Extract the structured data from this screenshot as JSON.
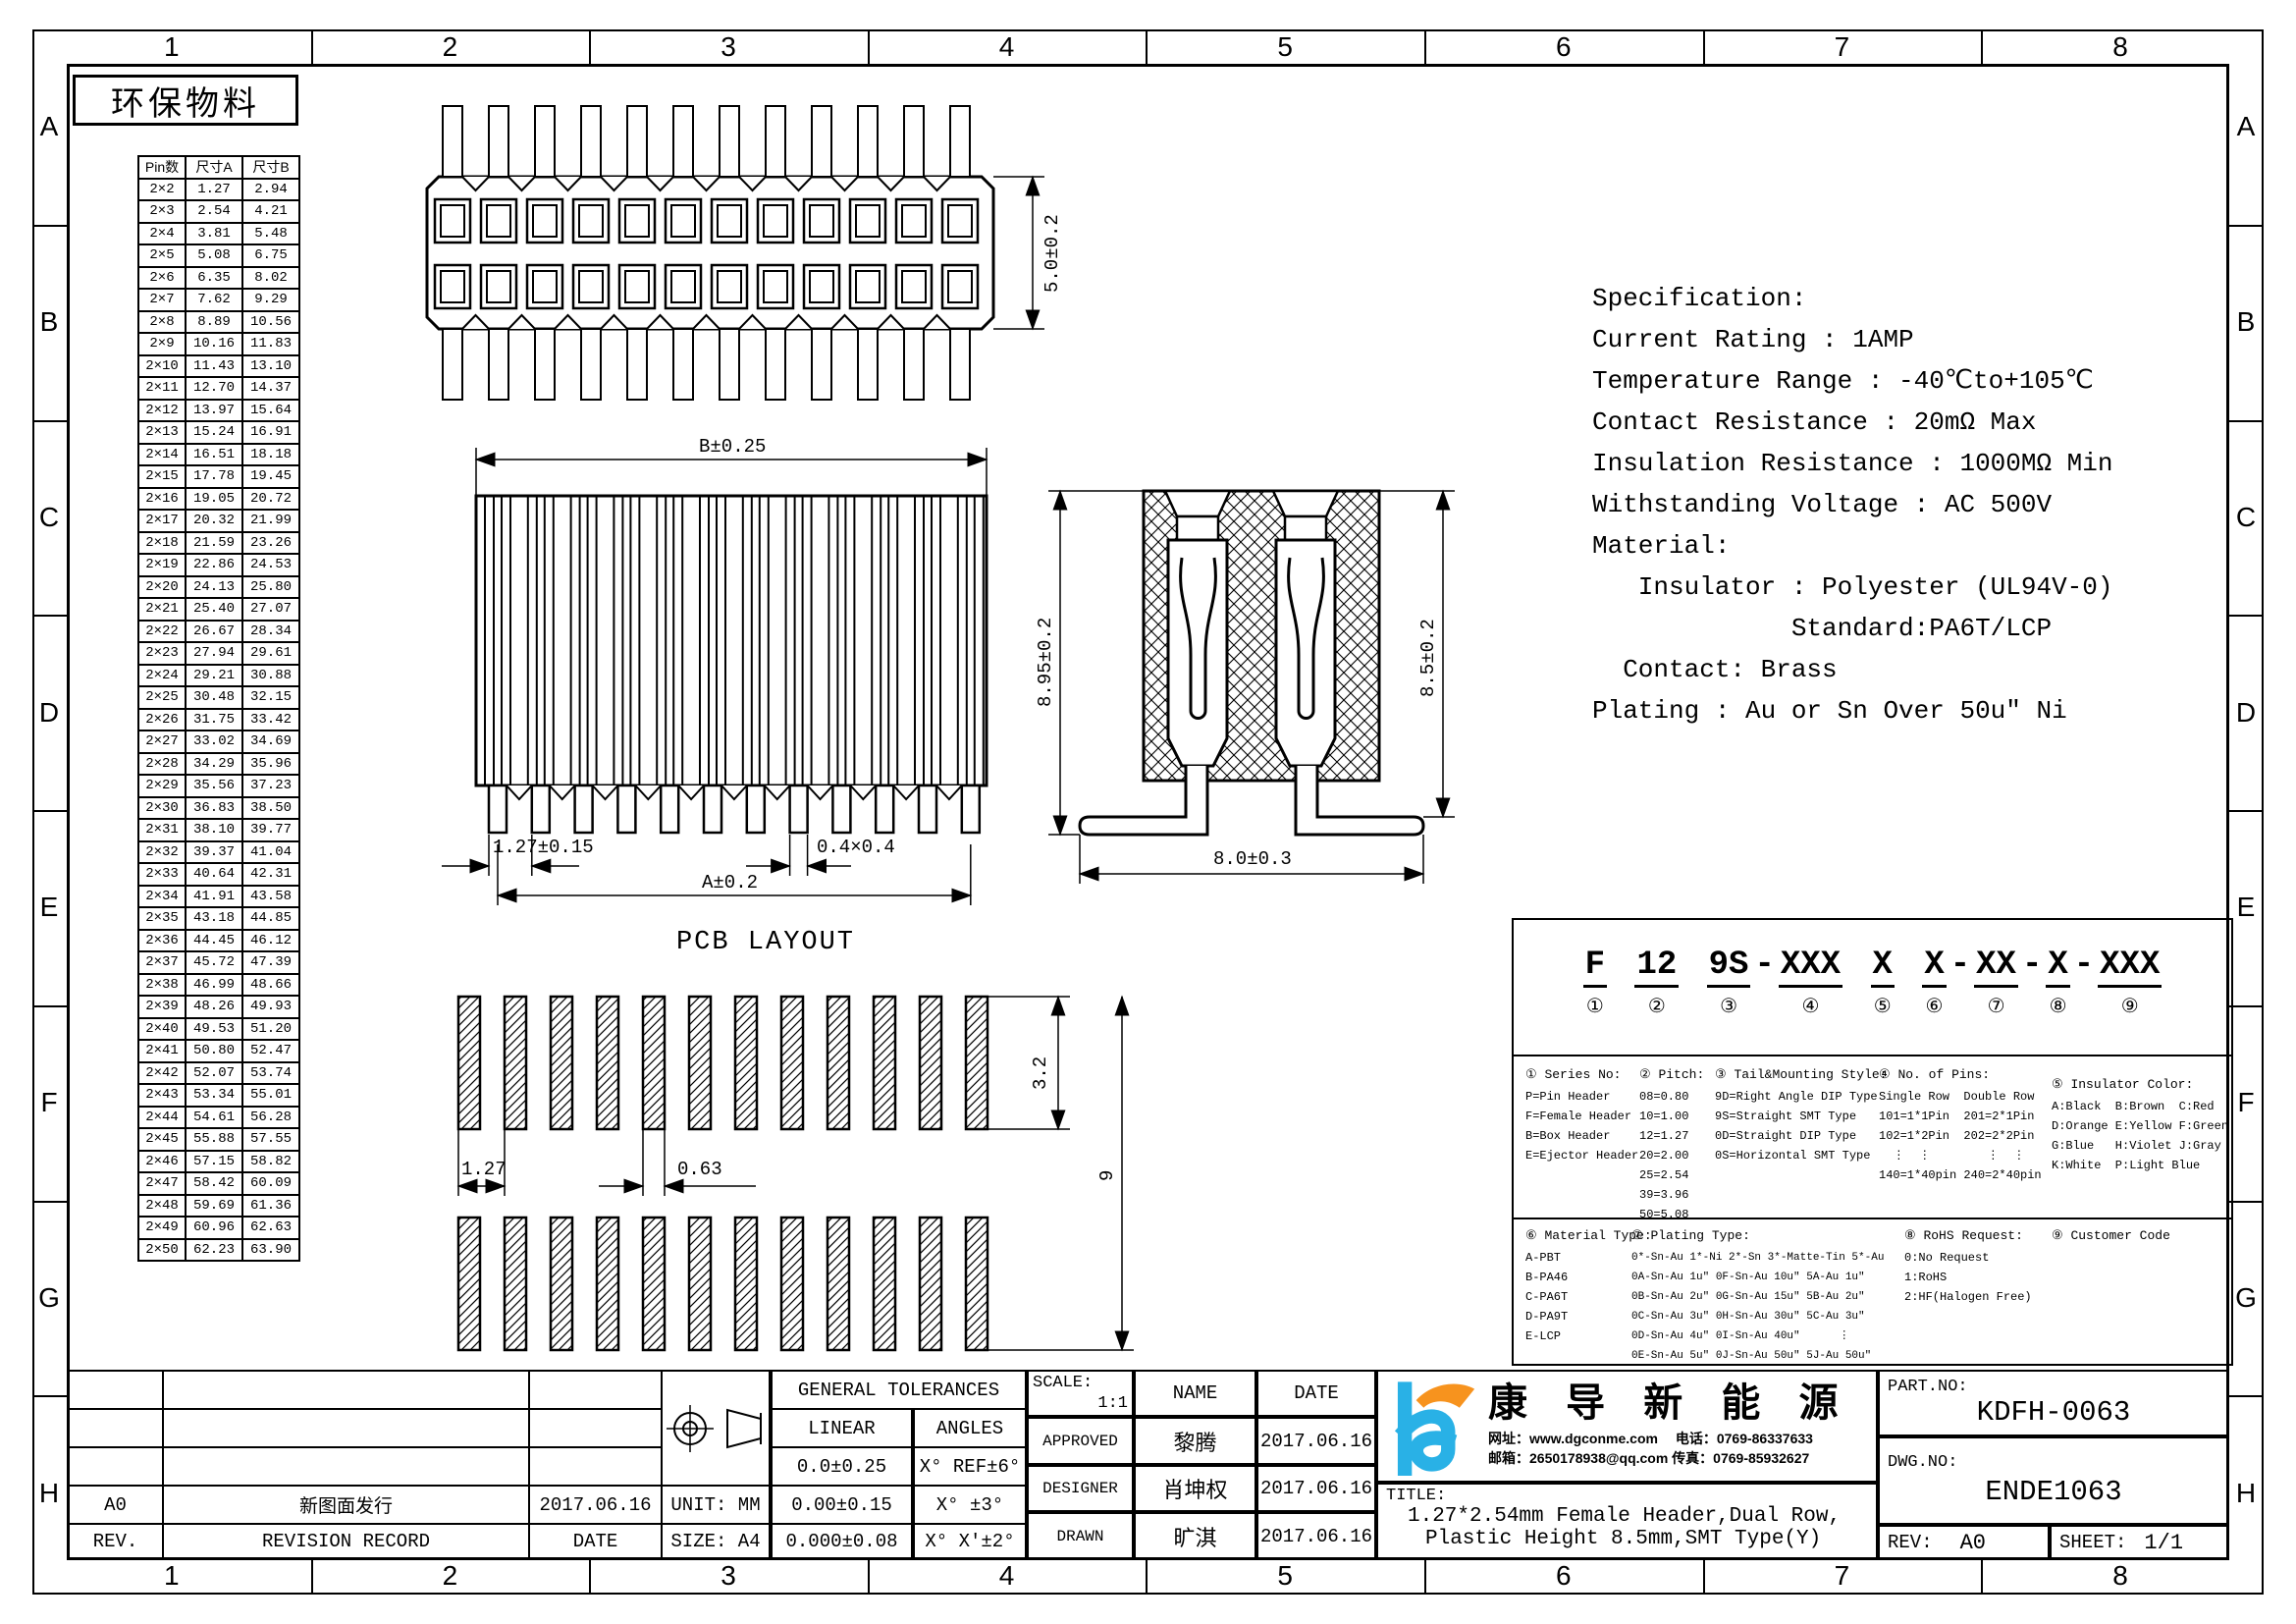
{
  "page": {
    "eco_label": "环保物料",
    "pcb_layout_title": "PCB LAYOUT"
  },
  "zones": {
    "columns": [
      "1",
      "2",
      "3",
      "4",
      "5",
      "6",
      "7",
      "8"
    ],
    "rows": [
      "A",
      "B",
      "C",
      "D",
      "E",
      "F",
      "G",
      "H"
    ]
  },
  "pin_table": {
    "headers": [
      "Pin数",
      "尺寸A",
      "尺寸B"
    ],
    "rows": [
      [
        "2×2",
        "1.27",
        "2.94"
      ],
      [
        "2×3",
        "2.54",
        "4.21"
      ],
      [
        "2×4",
        "3.81",
        "5.48"
      ],
      [
        "2×5",
        "5.08",
        "6.75"
      ],
      [
        "2×6",
        "6.35",
        "8.02"
      ],
      [
        "2×7",
        "7.62",
        "9.29"
      ],
      [
        "2×8",
        "8.89",
        "10.56"
      ],
      [
        "2×9",
        "10.16",
        "11.83"
      ],
      [
        "2×10",
        "11.43",
        "13.10"
      ],
      [
        "2×11",
        "12.70",
        "14.37"
      ],
      [
        "2×12",
        "13.97",
        "15.64"
      ],
      [
        "2×13",
        "15.24",
        "16.91"
      ],
      [
        "2×14",
        "16.51",
        "18.18"
      ],
      [
        "2×15",
        "17.78",
        "19.45"
      ],
      [
        "2×16",
        "19.05",
        "20.72"
      ],
      [
        "2×17",
        "20.32",
        "21.99"
      ],
      [
        "2×18",
        "21.59",
        "23.26"
      ],
      [
        "2×19",
        "22.86",
        "24.53"
      ],
      [
        "2×20",
        "24.13",
        "25.80"
      ],
      [
        "2×21",
        "25.40",
        "27.07"
      ],
      [
        "2×22",
        "26.67",
        "28.34"
      ],
      [
        "2×23",
        "27.94",
        "29.61"
      ],
      [
        "2×24",
        "29.21",
        "30.88"
      ],
      [
        "2×25",
        "30.48",
        "32.15"
      ],
      [
        "2×26",
        "31.75",
        "33.42"
      ],
      [
        "2×27",
        "33.02",
        "34.69"
      ],
      [
        "2×28",
        "34.29",
        "35.96"
      ],
      [
        "2×29",
        "35.56",
        "37.23"
      ],
      [
        "2×30",
        "36.83",
        "38.50"
      ],
      [
        "2×31",
        "38.10",
        "39.77"
      ],
      [
        "2×32",
        "39.37",
        "41.04"
      ],
      [
        "2×33",
        "40.64",
        "42.31"
      ],
      [
        "2×34",
        "41.91",
        "43.58"
      ],
      [
        "2×35",
        "43.18",
        "44.85"
      ],
      [
        "2×36",
        "44.45",
        "46.12"
      ],
      [
        "2×37",
        "45.72",
        "47.39"
      ],
      [
        "2×38",
        "46.99",
        "48.66"
      ],
      [
        "2×39",
        "48.26",
        "49.93"
      ],
      [
        "2×40",
        "49.53",
        "51.20"
      ],
      [
        "2×41",
        "50.80",
        "52.47"
      ],
      [
        "2×42",
        "52.07",
        "53.74"
      ],
      [
        "2×43",
        "53.34",
        "55.01"
      ],
      [
        "2×44",
        "54.61",
        "56.28"
      ],
      [
        "2×45",
        "55.88",
        "57.55"
      ],
      [
        "2×46",
        "57.15",
        "58.82"
      ],
      [
        "2×47",
        "58.42",
        "60.09"
      ],
      [
        "2×48",
        "59.69",
        "61.36"
      ],
      [
        "2×49",
        "60.96",
        "62.63"
      ],
      [
        "2×50",
        "62.23",
        "63.90"
      ]
    ]
  },
  "specification": {
    "lines": [
      "Specification:",
      "Current Rating : 1AMP",
      "Temperature Range : -40℃to+105℃",
      "Contact Resistance : 20mΩ Max",
      "Insulation Resistance : 1000MΩ Min",
      "Withstanding Voltage : AC 500V",
      "Material:",
      "   Insulator : Polyester (UL94V-0)",
      "             Standard:PA6T/LCP",
      "  Contact: Brass",
      "Plating : Au or Sn Over 50u″ Ni"
    ]
  },
  "dimensions": {
    "top_view_depth": "5.0±0.2",
    "front_b": "B±0.25",
    "front_pitch": "1.27±0.15",
    "front_sq": "0.4×0.4",
    "front_a": "A±0.2",
    "side_total": "8.95±0.2",
    "side_body": "8.5±0.2",
    "side_width": "8.0±0.3",
    "pcb_pitch": "1.27",
    "pcb_pad_w": "0.63",
    "pcb_pad_h": "3.2",
    "pcb_span": "9"
  },
  "part_code": {
    "segments": [
      {
        "t": "F",
        "n": "①",
        "sep": " "
      },
      {
        "t": "12",
        "n": "②",
        "sep": " "
      },
      {
        "t": "9S",
        "n": "③",
        "sep": "-"
      },
      {
        "t": "XXX",
        "n": "④",
        "sep": " "
      },
      {
        "t": "X",
        "n": "⑤",
        "sep": " "
      },
      {
        "t": "X",
        "n": "⑥",
        "sep": "-"
      },
      {
        "t": "XX",
        "n": "⑦",
        "sep": "-"
      },
      {
        "t": "X",
        "n": "⑧",
        "sep": "-"
      },
      {
        "t": "XXX",
        "n": "⑨",
        "sep": ""
      }
    ],
    "sections": {
      "series": {
        "title": "① Series No:",
        "lines": [
          "P=Pin Header",
          "F=Female Header",
          "B=Box Header",
          "E=Ejector Header"
        ]
      },
      "pitch": {
        "title": "② Pitch:",
        "lines": [
          "08=0.80",
          "10=1.00",
          "12=1.27",
          "20=2.00",
          "25=2.54",
          "39=3.96",
          "50=5.08"
        ]
      },
      "tail": {
        "title": "③ Tail&Mounting Style:",
        "lines": [
          "9D=Right Angle DIP Type",
          "9S=Straight SMT Type",
          "0D=Straight DIP Type",
          "0S=Horizontal SMT Type"
        ]
      },
      "pins": {
        "title": "④ No. of Pins:",
        "lines": [
          "Single Row  Double Row",
          "101=1*1Pin  201=2*1Pin",
          "102=1*2Pin  202=2*2Pin",
          "  ⋮  ⋮        ⋮  ⋮",
          "140=1*40pin 240=2*40pin"
        ]
      },
      "color": {
        "title": "⑤ Insulator Color:",
        "lines": [
          "A:Black  B:Brown  C:Red",
          "D:Orange E:Yellow F:Green",
          "G:Blue   H:Violet J:Gray",
          "K:White  P:Light Blue"
        ]
      },
      "material": {
        "title": "⑥ Material Type:",
        "lines": [
          "A-PBT",
          "B-PA46",
          "C-PA6T",
          "D-PA9T",
          "E-LCP"
        ]
      },
      "plating": {
        "title": "⑦ Plating Type:",
        "lines": [
          "0*-Sn-Au 1*-Ni 2*-Sn 3*-Matte-Tin 5*-Au",
          "0A-Sn-Au 1u″ 0F-Sn-Au 10u″ 5A-Au 1u″",
          "0B-Sn-Au 2u″ 0G-Sn-Au 15u″ 5B-Au 2u″",
          "0C-Sn-Au 3u″ 0H-Sn-Au 30u″ 5C-Au 3u″",
          "0D-Sn-Au 4u″ 0I-Sn-Au 40u″      ⋮",
          "0E-Sn-Au 5u″ 0J-Sn-Au 50u″ 5J-Au 50u″"
        ]
      },
      "rohs": {
        "title": "⑧ RoHS Request:",
        "lines": [
          "0:No Request",
          "1:RoHS",
          "2:HF(Halogen Free)"
        ]
      },
      "customer": {
        "title": "⑨ Customer Code",
        "lines": []
      }
    }
  },
  "title_block": {
    "general_tolerances": {
      "title": "GENERAL TOLERANCES",
      "linear_header": "LINEAR",
      "angles_header": "ANGLES",
      "rows": [
        [
          "0.0±0.25",
          "X° REF±6°"
        ],
        [
          "0.00±0.15",
          "X° ±3°"
        ],
        [
          "0.000±0.08",
          "X° X'±2°"
        ]
      ]
    },
    "unit_label": "UNIT: MM",
    "size_label": "SIZE: A4",
    "revision": {
      "rev_value": "A0",
      "record_value": "新图面发行",
      "date_value": "2017.06.16",
      "rev_header": "REV.",
      "record_header": "REVISION RECORD",
      "date_header": "DATE"
    },
    "scale_label": "SCALE:",
    "scale_value": "1:1",
    "name_header": "NAME",
    "date_header": "DATE",
    "approvals": [
      {
        "role": "APPROVED",
        "name": "黎腾",
        "date": "2017.06.16"
      },
      {
        "role": "DESIGNER",
        "name": "肖坤权",
        "date": "2017.06.16"
      },
      {
        "role": "DRAWN",
        "name": "旷淇",
        "date": "2017.06.16"
      }
    ],
    "company": {
      "name": "康 导 新 能 源",
      "contact_line1": "网址：www.dgconme.com　 电话：0769-86337633",
      "contact_line2": "邮箱：2650178938@qq.com 传真：0769-85932627"
    },
    "title_label": "TITLE:",
    "title_line1": "1.27*2.54mm Female Header,Dual Row,",
    "title_line2": "Plastic Height 8.5mm,SMT Type(Y)",
    "part_no_label": "PART.NO:",
    "part_no": "KDFH-0063",
    "dwg_no_label": "DWG.NO:",
    "dwg_no": "ENDE1063",
    "rev_label": "REV:",
    "rev": "A0",
    "sheet_label": "SHEET:",
    "sheet": "1/1"
  },
  "colors": {
    "logo_blue": "#29b1e6",
    "logo_orange": "#f7931e",
    "line": "#000000"
  }
}
